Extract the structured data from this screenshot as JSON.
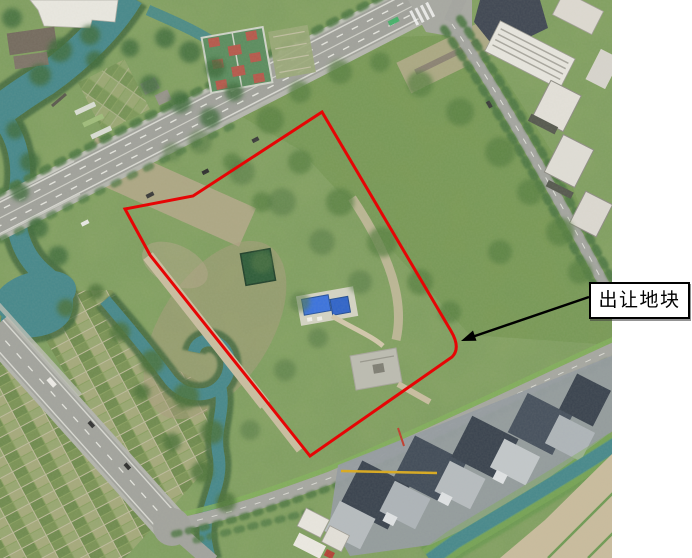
{
  "map": {
    "annotation": {
      "label": "出让地块",
      "box_background": "#ffffff",
      "box_border_color": "#000000",
      "arrow_color": "#000000"
    },
    "parcel": {
      "outline_color": "#e60505",
      "outline_width": "3"
    }
  }
}
